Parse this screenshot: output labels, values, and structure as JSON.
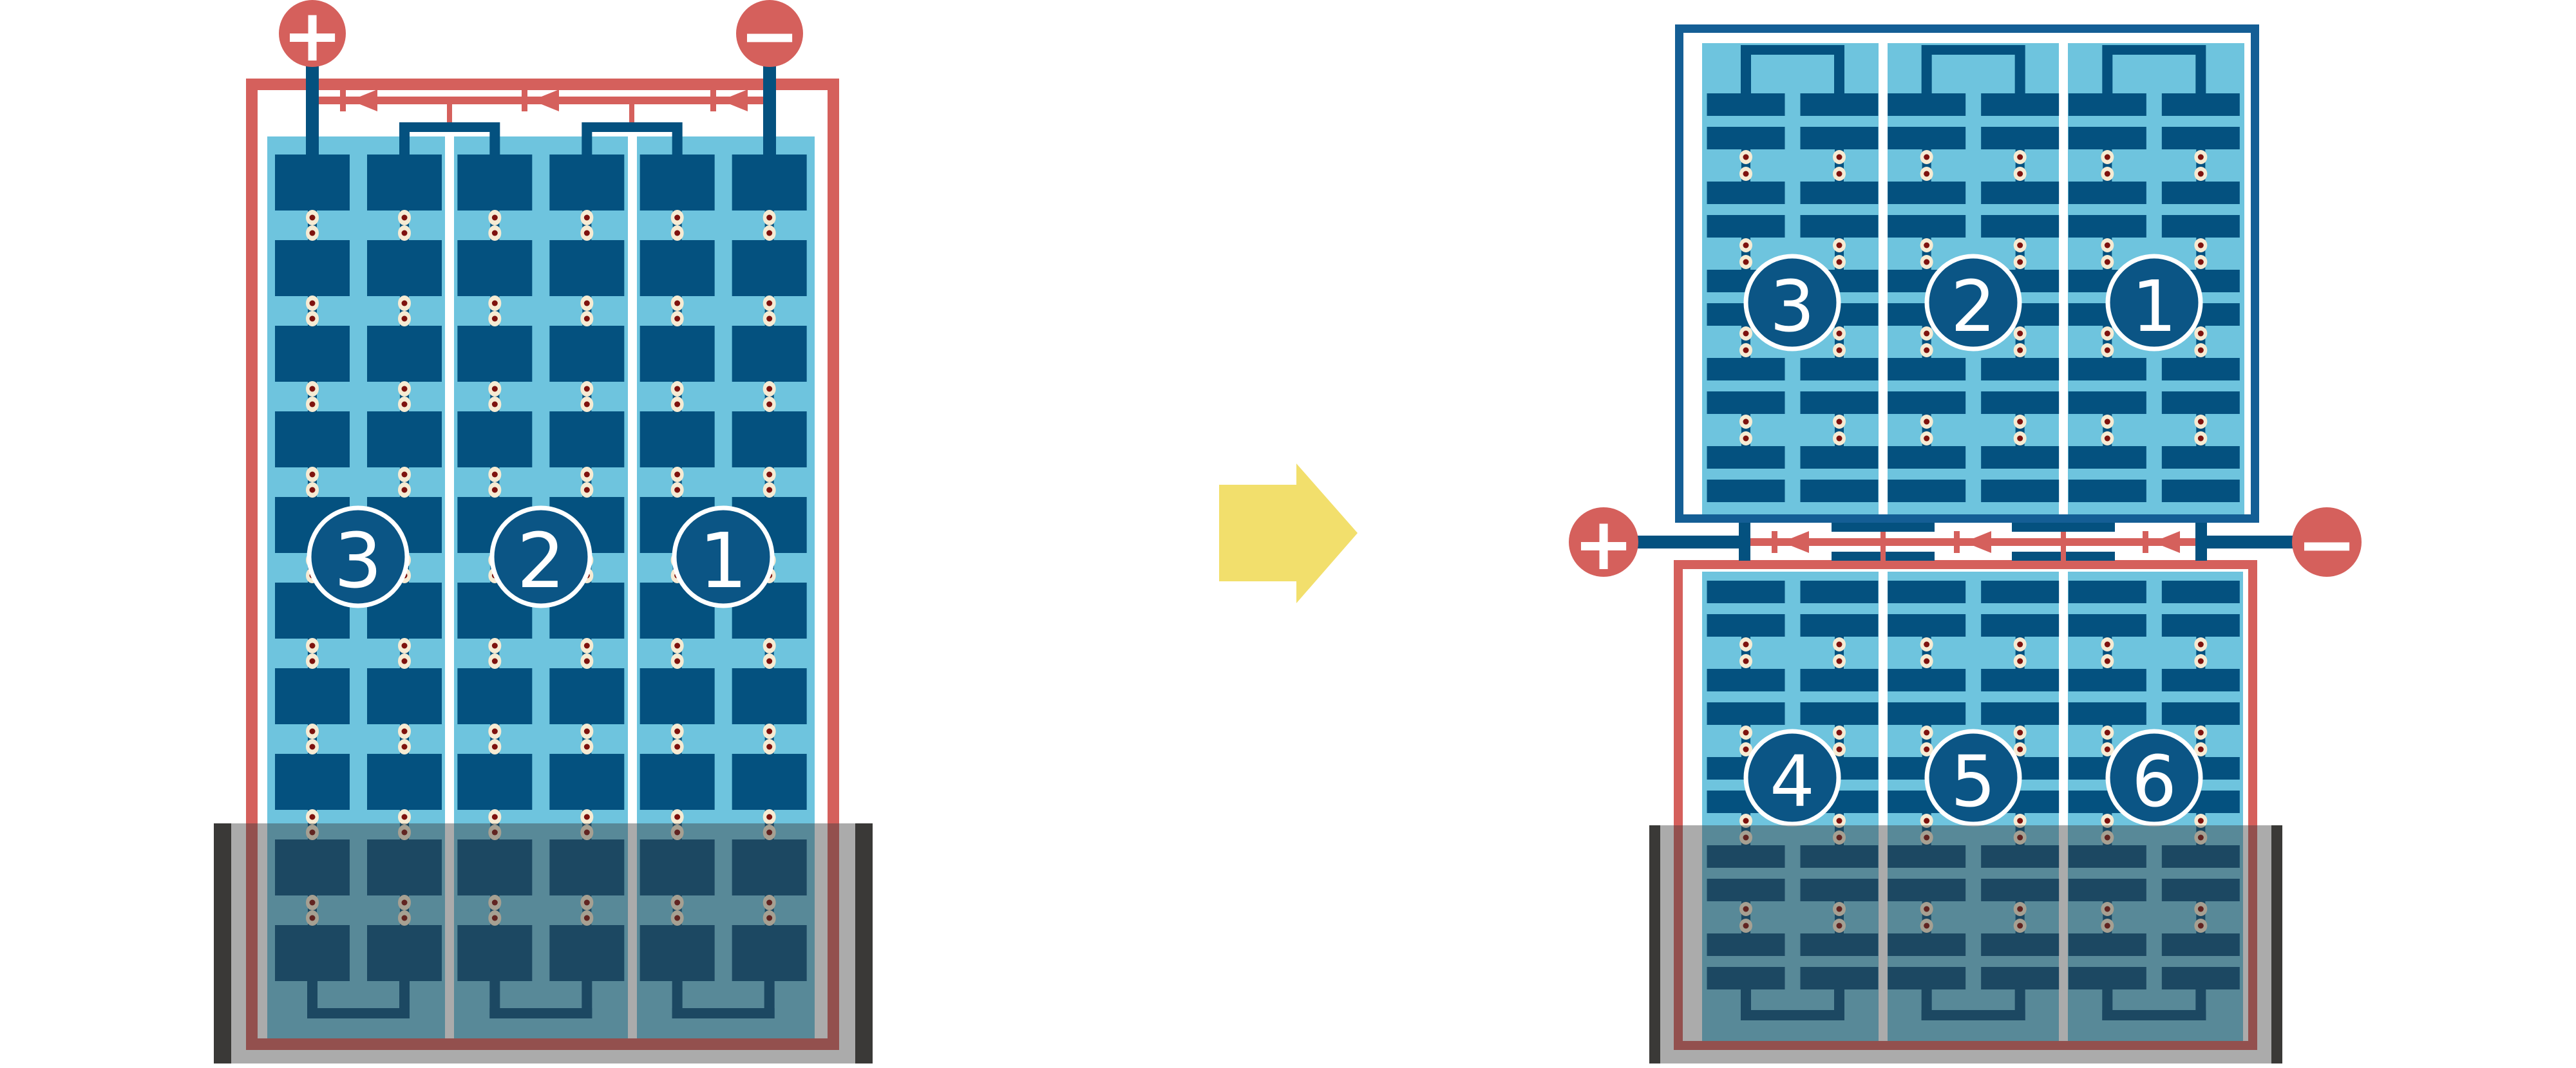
{
  "colors": {
    "red": "#D5605C",
    "dark_red": "#7E120E",
    "cell_blue": "#04517F",
    "frame_blue": "#145E95",
    "light_blue": "#6EC4DE",
    "circle_blue": "#0B5585",
    "cream": "#F6EBD3",
    "yellow": "#F2DF6C",
    "shade": "rgba(60,60,60,0.43)",
    "shade_bar": "#3A3937",
    "white": "#FFFFFF"
  },
  "left_module": {
    "positive_terminal": "+",
    "negative_terminal": "−",
    "string_labels": [
      "3",
      "2",
      "1"
    ]
  },
  "right_module": {
    "positive_terminal": "+",
    "negative_terminal": "−",
    "top_string_labels": [
      "3",
      "2",
      "1"
    ],
    "bottom_string_labels": [
      "4",
      "5",
      "6"
    ]
  }
}
